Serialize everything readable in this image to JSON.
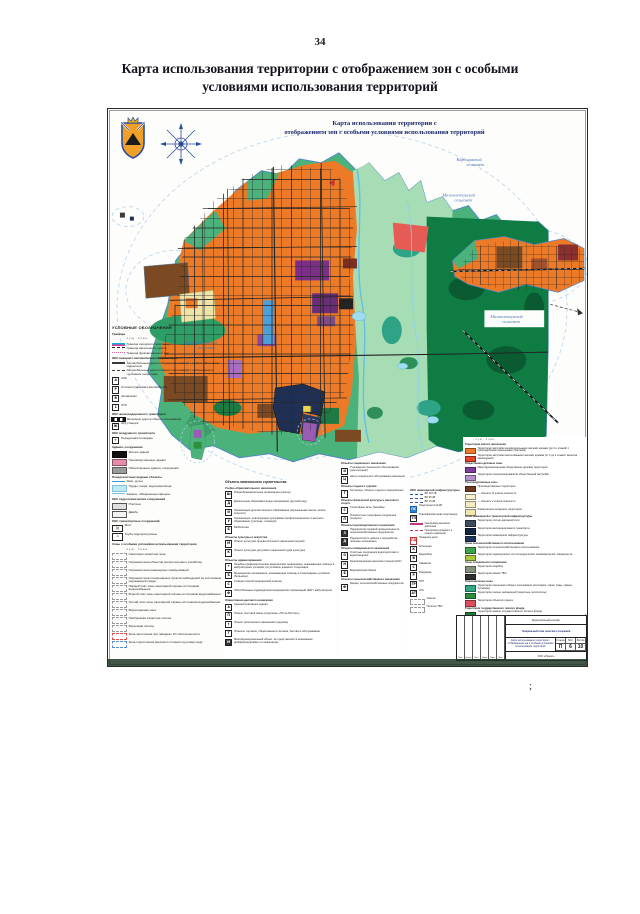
{
  "page": {
    "number": "34",
    "title_line1": "Карта использования территории с отображением зон с особыми",
    "title_line2": "условиями использования территорий",
    "stray_mark": ";"
  },
  "map": {
    "title_line1": "Карта использования территории с",
    "title_line2": "отображением зон с особыми условиями использования территорий",
    "labels": {
      "kardoniksky_1": "Кардоникский",
      "kardoniksky_2": "сельсовет",
      "malozel_top_1": "Малозеленчукский",
      "malozel_top_2": "сельсовет",
      "malozel_right_1": "Малозеленчукский",
      "malozel_right_2": "сельсовет",
      "prigorod_1": "Пригородненский",
      "prigorod_2": "сельсовет"
    },
    "colors": {
      "residential": "#ED7A27",
      "low_rise": "#E5472B",
      "green_fringe": "#4CB27C",
      "floodplain": "#A7DDB4",
      "forest": "#0E7C43",
      "public": "#7B2F87",
      "industrial": "#7B4A22",
      "water": "#66BFE3",
      "boundary": "#4E86C8"
    }
  },
  "legend_left": {
    "title": "УСЛОВНЫЕ ОБОЗНАЧЕНИЯ",
    "rows": [
      {
        "cls": "hdr",
        "sw": "sw-none",
        "label": "Границы"
      },
      {
        "cls": "note",
        "sw": "sw-none",
        "label": "сущ.        план."
      },
      {
        "sw": "sw-double",
        "label": "Граница городского поселения"
      },
      {
        "sw": "sw-dash",
        "b": "#222222",
        "label": "Граница населенного пункта"
      },
      {
        "sw": "sw-dots",
        "label": "Граница функциональных зон"
      },
      {
        "cls": "hdr",
        "sw": "sw-none",
        "label": "ОКС внешнего автомобильного транспорта"
      },
      {
        "sw": "sw-line2",
        "c": "#3a3a3a",
        "label": "Автомобильные дороги общего пользования с асфальтобетонным покрытием"
      },
      {
        "sw": "sw-dash2",
        "label": "Автомобильные дороги общего пользования с щебеночным и грунтовым покрытием"
      },
      {
        "sw": "sw-icon",
        "g": "А",
        "label": "АЗС"
      },
      {
        "sw": "sw-icon",
        "g": "Р",
        "label": "Стоянки (парковки) автомобилей"
      },
      {
        "sw": "sw-icon",
        "g": "В",
        "label": "Автовокзал"
      },
      {
        "sw": "sw-icon",
        "g": "1",
        "label": "СТО"
      },
      {
        "cls": "hdr",
        "sw": "sw-none",
        "label": "ОКС железнодорожного транспорта"
      },
      {
        "sw": "sw-rail",
        "label": "Железные дороги общего пользования"
      },
      {
        "sw": "sw-icon",
        "g": "Ж",
        "label": "Ж/д станция"
      },
      {
        "cls": "hdr",
        "sw": "sw-none",
        "label": "ОКС воздушного транспорта"
      },
      {
        "sw": "sw-icon",
        "g": "✈",
        "label": "Посадочная площадка"
      },
      {
        "cls": "hdr",
        "sw": "sw-none",
        "label": "Здания, сооружения"
      },
      {
        "sw": "sw-rect",
        "c": "#111111",
        "label": "Жилые здания"
      },
      {
        "sw": "sw-rect",
        "c": "#e78ba8",
        "label": "Производственные здания"
      },
      {
        "sw": "sw-rect",
        "c": "#9a9a9a",
        "label": "Общественные здания, сооружения"
      },
      {
        "cls": "hdr",
        "sw": "sw-none",
        "label": "Поверхностные водные объекты"
      },
      {
        "sw": "sw-line",
        "c": "#2e9bd6",
        "label": "Реки, ручьи"
      },
      {
        "sw": "sw-rect",
        "c": "#bfe8f2",
        "b": "#7fc4dc",
        "label": "Пруды, озера, водохранилища"
      },
      {
        "sw": "sw-line",
        "c": "#7fc4dc",
        "label": "Каналы, обводненные карьеры"
      },
      {
        "cls": "hdr",
        "sw": "sw-none",
        "label": "ОКС гидротехнических сооружений"
      },
      {
        "sw": "sw-rect",
        "c": "#dfdfdf",
        "b": "#555555",
        "label": "Плотина"
      },
      {
        "sw": "sw-rect",
        "c": "#f2f2f2",
        "b": "#555555",
        "label": "Дамба"
      },
      {
        "cls": "hdr",
        "sw": "sw-none",
        "label": "ОКС транспортных сооружений"
      },
      {
        "sw": "sw-icon sw-wide",
        "g": ")(",
        "label": "Мост"
      },
      {
        "sw": "sw-icon sw-wide",
        "g": "≍",
        "label": "Трубы водопропускные"
      },
      {
        "cls": "hdr",
        "sw": "sw-none",
        "label": "Зоны с особыми условиями использования территории"
      },
      {
        "cls": "note",
        "sw": "sw-none",
        "label": "сущ.        план."
      },
      {
        "sw": "sw-boxd",
        "b": "#9a9a9a",
        "label": "Санитарно-защитная зона"
      },
      {
        "sw": "sw-boxd",
        "b": "#9a9a9a",
        "label": "Охранная зона объектов электросетевого хозяйства"
      },
      {
        "sw": "sw-boxd",
        "b": "#9a9a9a",
        "label": "Охранная зона инженерных коммуникаций"
      },
      {
        "sw": "sw-boxd",
        "b": "#9a9a9a",
        "label": "Охранная зона стационарных пунктов наблюдений за состоянием окружающей среды"
      },
      {
        "sw": "sw-boxd",
        "b": "#9a9a9a",
        "label": "Первый пояс зоны санитарной охраны источников водоснабжения"
      },
      {
        "sw": "sw-boxd",
        "b": "#9a9a9a",
        "label": "Второй пояс зоны санитарной охраны источников водоснабжения"
      },
      {
        "sw": "sw-boxd",
        "b": "#9a9a9a",
        "label": "Третий пояс зоны санитарной охраны источников водоснабжения"
      },
      {
        "sw": "sw-boxd",
        "b": "#9a9a9a",
        "label": "Водоохранная зона"
      },
      {
        "sw": "sw-boxd",
        "b": "#9a9a9a",
        "label": "Прибрежная защитная полоса"
      },
      {
        "sw": "sw-boxd",
        "b": "#9a9a9a",
        "label": "Береговая полоса"
      },
      {
        "sw": "sw-boxd",
        "b": "#e05050",
        "label": "Зона затопления при паводках 1% обеспеченности"
      },
      {
        "sw": "sw-boxd",
        "b": "#5b8fd0",
        "label": "Зона подтопления (высокого стояния грунтовых вод)"
      }
    ]
  },
  "legend_obj1": {
    "title": "Объекты капитального строительства",
    "rows": [
      {
        "cls": "hdr",
        "sw": "sw-none",
        "label": "Учебно-образовательного назначения"
      },
      {
        "sw": "sw-icon",
        "g": "Ш",
        "label": "Общеобразовательные организации (школы)"
      },
      {
        "sw": "sw-icon",
        "g": "Д",
        "label": "Дошкольные образовательные организации (детский сад)"
      },
      {
        "sw": "sw-icon",
        "g": "И",
        "label": "Организации дополнительного образования (музыкальная школа, школа искусств)"
      },
      {
        "sw": "sw-icon",
        "g": "У",
        "label": "Организации, реализующие программы профессионального и высшего образования (училище, техникум)"
      },
      {
        "sw": "sw-icon",
        "g": "Б",
        "label": "Библиотека"
      },
      {
        "cls": "hdr",
        "sw": "sw-none",
        "label": "Объекты культуры и искусства"
      },
      {
        "sw": "sw-icon",
        "g": "М",
        "label": "Объект культурно-просветительного назначения (музей)"
      },
      {
        "sw": "sw-icon",
        "g": "К",
        "label": "Объект культурно-досугового назначения (дом культуры)"
      },
      {
        "cls": "hdr",
        "sw": "sw-none",
        "label": "Объекты здравоохранения"
      },
      {
        "sw": "sw-icon",
        "g": "+",
        "label": "Лечебно-профилактические медицинские организации, оказывающие помощь в амбулаторных условиях и в условиях дневного стационара"
      },
      {
        "sw": "sw-icon",
        "g": "Б",
        "label": "Медицинские организации, оказывающие помощь в стационарных условиях (больница)"
      },
      {
        "sw": "sw-icon",
        "g": "С",
        "label": "Станция скорой медицинской помощи"
      },
      {
        "sw": "sw-icon",
        "g": "Ф",
        "label": "Обособленные подразделения медицинских организаций (ФАП, амбулатория)"
      },
      {
        "cls": "hdr",
        "sw": "sw-none",
        "label": "Общественно-делового назначения"
      },
      {
        "sw": "sw-icon",
        "g": "А",
        "label": "Административные здания"
      },
      {
        "sw": "sw-icon",
        "g": "П",
        "label": "Объект почтовой связи (отделение «Почта России»)"
      },
      {
        "sw": "sw-icon",
        "g": "†",
        "label": "Объект религиозного назначения (церковь)"
      },
      {
        "sw": "sw-icon",
        "g": "Т",
        "label": "Объекты торговли, общественного питания, бытового обслуживания"
      },
      {
        "sw": "sw-icon sw-darkk",
        "g": "М",
        "label": "Многофункциональный объект, не представляется возможным дифференцировать по назначению"
      }
    ]
  },
  "legend_obj2": {
    "rows": [
      {
        "cls": "hdr",
        "sw": "sw-none",
        "label": "Объекты социального назначения"
      },
      {
        "sw": "sw-icon",
        "g": "И",
        "label": "Учреждения социального обслуживания (дом-интернат)"
      },
      {
        "sw": "sw-icon",
        "g": "Ц",
        "label": "Центр социального обслуживания населения"
      },
      {
        "cls": "hdr",
        "sw": "sw-none",
        "label": "Объекты отдыха и туризма"
      },
      {
        "sw": "sw-icon",
        "g": "Г",
        "label": "Гостиницы, объекты отдыха и оздоровления"
      },
      {
        "cls": "hdr",
        "sw": "sw-none",
        "label": "Объекты физической культуры и массового спорта"
      },
      {
        "sw": "sw-icon",
        "g": "С",
        "label": "Спортивные залы, бассейны"
      },
      {
        "sw": "sw-icon",
        "g": "П",
        "label": "Плоскостные спортивные сооружения (стадион)"
      },
      {
        "cls": "hdr",
        "sw": "sw-none",
        "label": "Объекты производственного назначения"
      },
      {
        "sw": "sw-icon sw-darkk",
        "g": "З",
        "label": "Предприятия пищевой промышленности, сельскохозяйственные предприятия"
      },
      {
        "sw": "sw-icon sw-darkk",
        "g": "Д",
        "label": "Предприятия по добыче и переработке полезных ископаемых"
      },
      {
        "cls": "hdr",
        "sw": "sw-none",
        "label": "Объекты коммунального назначения"
      },
      {
        "sw": "sw-icon",
        "g": "О",
        "label": "Очистные сооружения водоподготовки и водоотведения"
      },
      {
        "sw": "sw-icon",
        "g": "Н",
        "label": "Канализационная насосная станция (КНС)"
      },
      {
        "sw": "sw-icon",
        "g": "Б",
        "label": "Водонапорная башня"
      },
      {
        "cls": "hdr",
        "sw": "sw-none",
        "label": "Объекты сельскохозяйственного назначения"
      },
      {
        "sw": "sw-icon",
        "g": "Ф",
        "label": "Фермы, сельскохозяйственные предприятия"
      }
    ]
  },
  "legend_eng": {
    "title": "ОКС инженерной инфраструктуры",
    "rows": [
      {
        "sw": "sw-linedot",
        "label": "ВЛ 110 кВ"
      },
      {
        "sw": "sw-linedot",
        "label": "ВЛ 35 кВ"
      },
      {
        "sw": "sw-linedot",
        "label": "ВЛ 10 кВ"
      },
      {
        "sw": "sw-icon sw-blue",
        "g": "ПС",
        "label": "Подстанция 110 кВ"
      },
      {
        "sw": "sw-icon",
        "g": "ТП",
        "label": "Трансформаторная подстанция"
      },
      {
        "sw": "sw-line",
        "c": "#c03878",
        "label": "Газопровод высокого давления"
      },
      {
        "sw": "sw-dash",
        "b": "#c03878",
        "label": "Газопровод среднего и низкого давления"
      },
      {
        "sw": "sw-icon sw-red",
        "g": "ПД",
        "label": "Пожарное депо"
      },
      {
        "sw": "sw-icon",
        "g": "К",
        "label": "Котельная"
      },
      {
        "sw": "sw-icon",
        "g": "В",
        "label": "Водозабор"
      },
      {
        "sw": "sw-icon",
        "g": "С",
        "label": "Скважина"
      },
      {
        "sw": "sw-icon",
        "g": "Р",
        "label": "Резервуар"
      },
      {
        "sw": "sw-icon",
        "g": "ГР",
        "label": "ГРП"
      },
      {
        "sw": "sw-icon",
        "g": "АТ",
        "label": "АТС"
      },
      {
        "sw": "sw-boxd",
        "b": "#999999",
        "label": "Свалка"
      },
      {
        "sw": "sw-boxd",
        "b": "#999999",
        "label": "Полигон ТБО"
      }
    ]
  },
  "legend_zones": {
    "rows": [
      {
        "cls": "note",
        "sw": "sw-none",
        "label": "сущ.     план."
      },
      {
        "cls": "hdr",
        "sw": "sw-none",
        "label": "Территории жилого назначения"
      },
      {
        "sw": "sw-rect",
        "c": "#ed7c2b",
        "label": "Территория застройки индивидуальными жилыми домами (до 3-х этажей) с приусадебными земельными участками"
      },
      {
        "sw": "sw-rect",
        "c": "#e5472b",
        "label": "Территория застройки малоэтажными жилыми домами (от 2 до 4 этажей, включая мансардный)"
      },
      {
        "cls": "hdr",
        "sw": "sw-none",
        "label": "Общественно-деловые зоны"
      },
      {
        "sw": "sw-rect",
        "c": "#7c3f9e",
        "label": "Многофункциональная общественно-деловая территория"
      },
      {
        "sw": "sw-rect",
        "c": "#b591cc",
        "label": "Территория специализированной общественной застройки"
      },
      {
        "cls": "hdr",
        "sw": "sw-none",
        "label": "Производственные зоны"
      },
      {
        "sw": "sw-rect",
        "c": "#6e3b1e",
        "label": "Производственные территории"
      },
      {
        "sw": "sw-rect",
        "c": "#f6f0cc",
        "label": "— объекты IV класса опасности"
      },
      {
        "sw": "sw-rect",
        "c": "#f3ecc0",
        "label": "— объекты V класса опасности"
      },
      {
        "sw": "sw-rect",
        "c": "#efe6b0",
        "label": "Коммунально-складские территории"
      },
      {
        "cls": "hdr",
        "sw": "sw-none",
        "label": "Зоны инженерной и транспортной инфраструктуры"
      },
      {
        "sw": "sw-rect",
        "c": "#3d4a5e",
        "label": "Территория улично-дорожной сети"
      },
      {
        "sw": "sw-rect",
        "c": "#152441",
        "label": "Территория железнодорожного транспорта"
      },
      {
        "sw": "sw-rect",
        "c": "#24355c",
        "label": "Территория инженерной инфраструктуры"
      },
      {
        "cls": "hdr",
        "sw": "sw-none",
        "label": "Зоны сельскохозяйственного использования"
      },
      {
        "sw": "sw-rect",
        "c": "#3fa149",
        "label": "Территория сельскохозяйственного использования"
      },
      {
        "sw": "sw-rect",
        "c": "#a9c93f",
        "label": "Территория садоводческих или огороднических некоммерческих товариществ"
      },
      {
        "cls": "hdr",
        "sw": "sw-none",
        "label": "Зоны специального назначения"
      },
      {
        "sw": "sw-rect",
        "c": "#84917f",
        "label": "Территория кладбищ"
      },
      {
        "sw": "sw-rect",
        "c": "#2f2f2f",
        "label": "Территория свалки ТБО"
      },
      {
        "cls": "hdr",
        "sw": "sw-none",
        "label": "Рекреационные зоны"
      },
      {
        "sw": "sw-rect",
        "c": "#35a584",
        "label": "Территория озеленения общего пользования (лесопарки, парки, сады, скверы, бульвары)"
      },
      {
        "sw": "sw-rect",
        "c": "#2f8f3f",
        "label": "Территория лесных насаждений (защитные лесополосы)"
      },
      {
        "sw": "sw-rect",
        "c": "#d9505c",
        "label": "Территория объектов отдыха"
      },
      {
        "cls": "hdr",
        "sw": "sw-none",
        "label": "Территории государственного лесного фонда"
      },
      {
        "sw": "sw-rect",
        "c": "#1e7a35",
        "label": "Территория земель государственного лесного фонда"
      },
      {
        "sw": "sw-rect",
        "c": "#57a85c",
        "label": "Территория защитных лесов"
      },
      {
        "cls": "hdr",
        "sw": "sw-none",
        "label": "Леса на землях иных категорий"
      },
      {
        "sw": "sw-boxd",
        "b": "#57a85c",
        "c": "#bfe3bf",
        "label": "Защитные лесные насаждения на землях сельскохозяйственного назначения"
      }
    ]
  },
  "stamp": {
    "contract": "Муниципальный контракт",
    "project": "Генеральный план сельского поселения",
    "sheet_name": "Карта использования территории с отображением зон с особыми условиями использования территорий",
    "row_labels": [
      "Изм.",
      "Кол.уч",
      "Лист",
      "№док",
      "Подп.",
      "Дата"
    ],
    "stage_label": "Стадия",
    "sheet_label": "Лист",
    "sheets_label": "Листов",
    "stage": "П",
    "sheet": "6",
    "sheets": "10",
    "org": "ООО «Проект»"
  }
}
